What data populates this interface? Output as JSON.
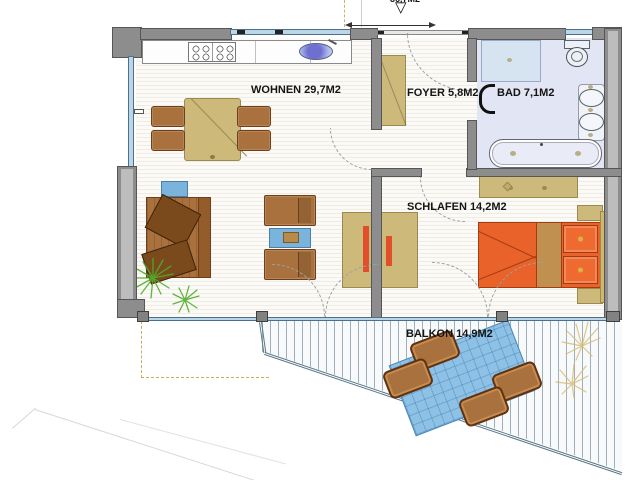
{
  "plan": {
    "top_note": {
      "label": "36,7M2"
    },
    "rooms": [
      {
        "key": "wohnen",
        "label": "WOHNEN 29,7M2"
      },
      {
        "key": "foyer",
        "label": "FOYER 5,8M2"
      },
      {
        "key": "bad",
        "label": "BAD 7,1M2"
      },
      {
        "key": "schlafen",
        "label": "SCHLAFEN 14,2M2"
      },
      {
        "key": "balkon",
        "label": "BALKON 14,9M2"
      }
    ],
    "colors": {
      "wall_gray": "#8d8d8d",
      "window_blue": "#bcd6e6",
      "bath_floor": "#e2e5f3",
      "wood_tan": "#cdb97a",
      "furniture_brown": "#a9713d",
      "bed_orange": "#e8622a",
      "accent_red": "#e14f2a",
      "water_blue": "#7ab4dc",
      "rug_blue": "#8ec1e6",
      "plant_green": "#4fae2a",
      "plant_tan": "#d6ba6e"
    }
  }
}
